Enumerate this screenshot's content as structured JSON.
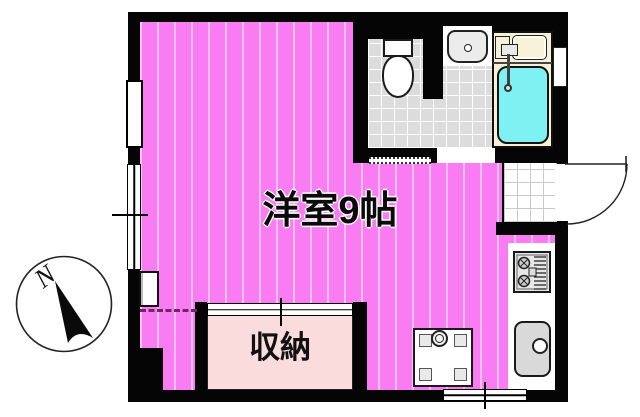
{
  "floorplan": {
    "room": {
      "label": "洋室9帖"
    },
    "closet": {
      "label": "収納"
    },
    "compass": {
      "label": "N"
    }
  },
  "colors": {
    "room-pink": "#F97CF2",
    "room-stripe": "#FCC2F8",
    "closet-pink": "#FADCDC",
    "tub-cyan": "#7EF2F2",
    "bath-cream": "#F6F1D7",
    "tile-gray": "#DCDCDC",
    "wall-black": "#050505",
    "dash-plum": "#6B2A5F"
  }
}
